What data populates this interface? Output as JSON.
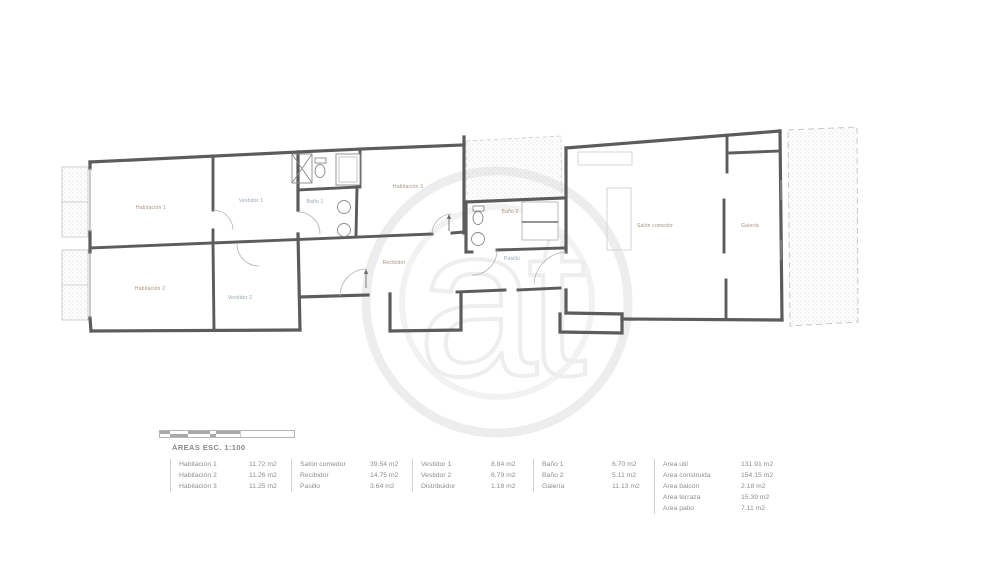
{
  "plan": {
    "rooms": {
      "habitacion1": "Habitación 1",
      "habitacion2": "Habitación 2",
      "habitacion3": "Habitación 3",
      "vestidor1": "Vestidor 1",
      "vestidor2": "Vestidor 2",
      "bano1": "Baño 1",
      "bano2": "Baño 2",
      "recibidor": "Recibidor",
      "pasillo": "Pasillo",
      "salon": "Salón comedor",
      "galeria": "Galería"
    },
    "watermark": "at",
    "colors": {
      "wall": "#5c5c5c",
      "fixture": "#8a8a8a",
      "hatch_dot": "#d8d8d8",
      "warm_label": "#a8927c",
      "cool_label": "#96a2b4"
    }
  },
  "legend": {
    "title": "ÁREAS ESC. 1:100",
    "groups": [
      {
        "rows": [
          {
            "label": "Habitación 1",
            "value": "11.72 m2"
          },
          {
            "label": "Habitación 2",
            "value": "11.26 m2"
          },
          {
            "label": "Habitación 3",
            "value": "11.25 m2"
          }
        ]
      },
      {
        "rows": [
          {
            "label": "Salón comedor",
            "value": "39.54 m2"
          },
          {
            "label": "Recibidor",
            "value": "14.75 m2"
          },
          {
            "label": "Pasillo",
            "value": "3.64 m2"
          }
        ]
      },
      {
        "rows": [
          {
            "label": "Vestidor 1",
            "value": "8.84 m2"
          },
          {
            "label": "Vestidor 2",
            "value": "6.79 m2"
          },
          {
            "label": "Distribuidor",
            "value": "1.18 m2"
          }
        ]
      },
      {
        "rows": [
          {
            "label": "Baño 1",
            "value": "6.70 m2"
          },
          {
            "label": "Baño 2",
            "value": "5.11 m2"
          },
          {
            "label": "Galería",
            "value": "11.13 m2"
          }
        ]
      },
      {
        "rows": [
          {
            "label": "Area util",
            "value": "131.91 m2"
          },
          {
            "label": "Area construida",
            "value": "154.15 m2"
          },
          {
            "label": "Area balcón",
            "value": "2.18 m2"
          },
          {
            "label": "Area terraza",
            "value": "15.39 m2"
          },
          {
            "label": "Area patio",
            "value": "7.11 m2"
          }
        ]
      }
    ]
  }
}
